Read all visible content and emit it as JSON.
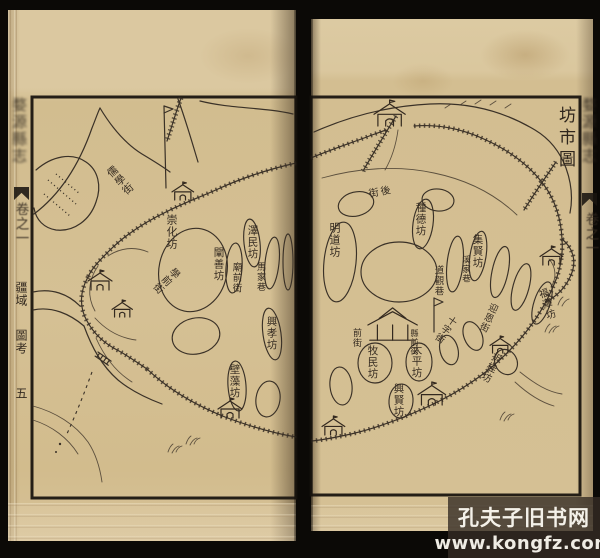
{
  "book": {
    "left_margin": {
      "spine_title": "婺源縣志",
      "volume_label": "卷之一",
      "section_upper": "疆域",
      "section_lower": "圖考",
      "folio_number": "五"
    },
    "right_margin": {
      "spine_title": "婺源縣志",
      "volume_label": "卷之一"
    }
  },
  "map": {
    "title": "坊市圖",
    "labels": [
      {
        "text": "儒學街"
      },
      {
        "text": "崇化坊"
      },
      {
        "text": "澤民坊"
      },
      {
        "text": "闡善坊"
      },
      {
        "text": "廟前街"
      },
      {
        "text": "馬家巷"
      },
      {
        "text": "學前街"
      },
      {
        "text": "興孝坊"
      },
      {
        "text": "壁藻坊"
      },
      {
        "text": "後街"
      },
      {
        "text": "明道坊"
      },
      {
        "text": "種德坊"
      },
      {
        "text": "集賢坊"
      },
      {
        "text": "溪家巷"
      },
      {
        "text": "道觀巷"
      },
      {
        "text": "前街"
      },
      {
        "text": "縣前街"
      },
      {
        "text": "牧民坊"
      },
      {
        "text": "太平坊"
      },
      {
        "text": "十字街"
      },
      {
        "text": "迎恩街"
      },
      {
        "text": "福澤坊"
      },
      {
        "text": "折桂坊"
      },
      {
        "text": "興賢坊"
      }
    ]
  },
  "watermark": {
    "site_name": "孔夫子旧书网",
    "site_url": "www.kongfz.com"
  },
  "colors": {
    "paper": "#d5c094",
    "ink": "#3a3127",
    "background": "#0b0906"
  }
}
